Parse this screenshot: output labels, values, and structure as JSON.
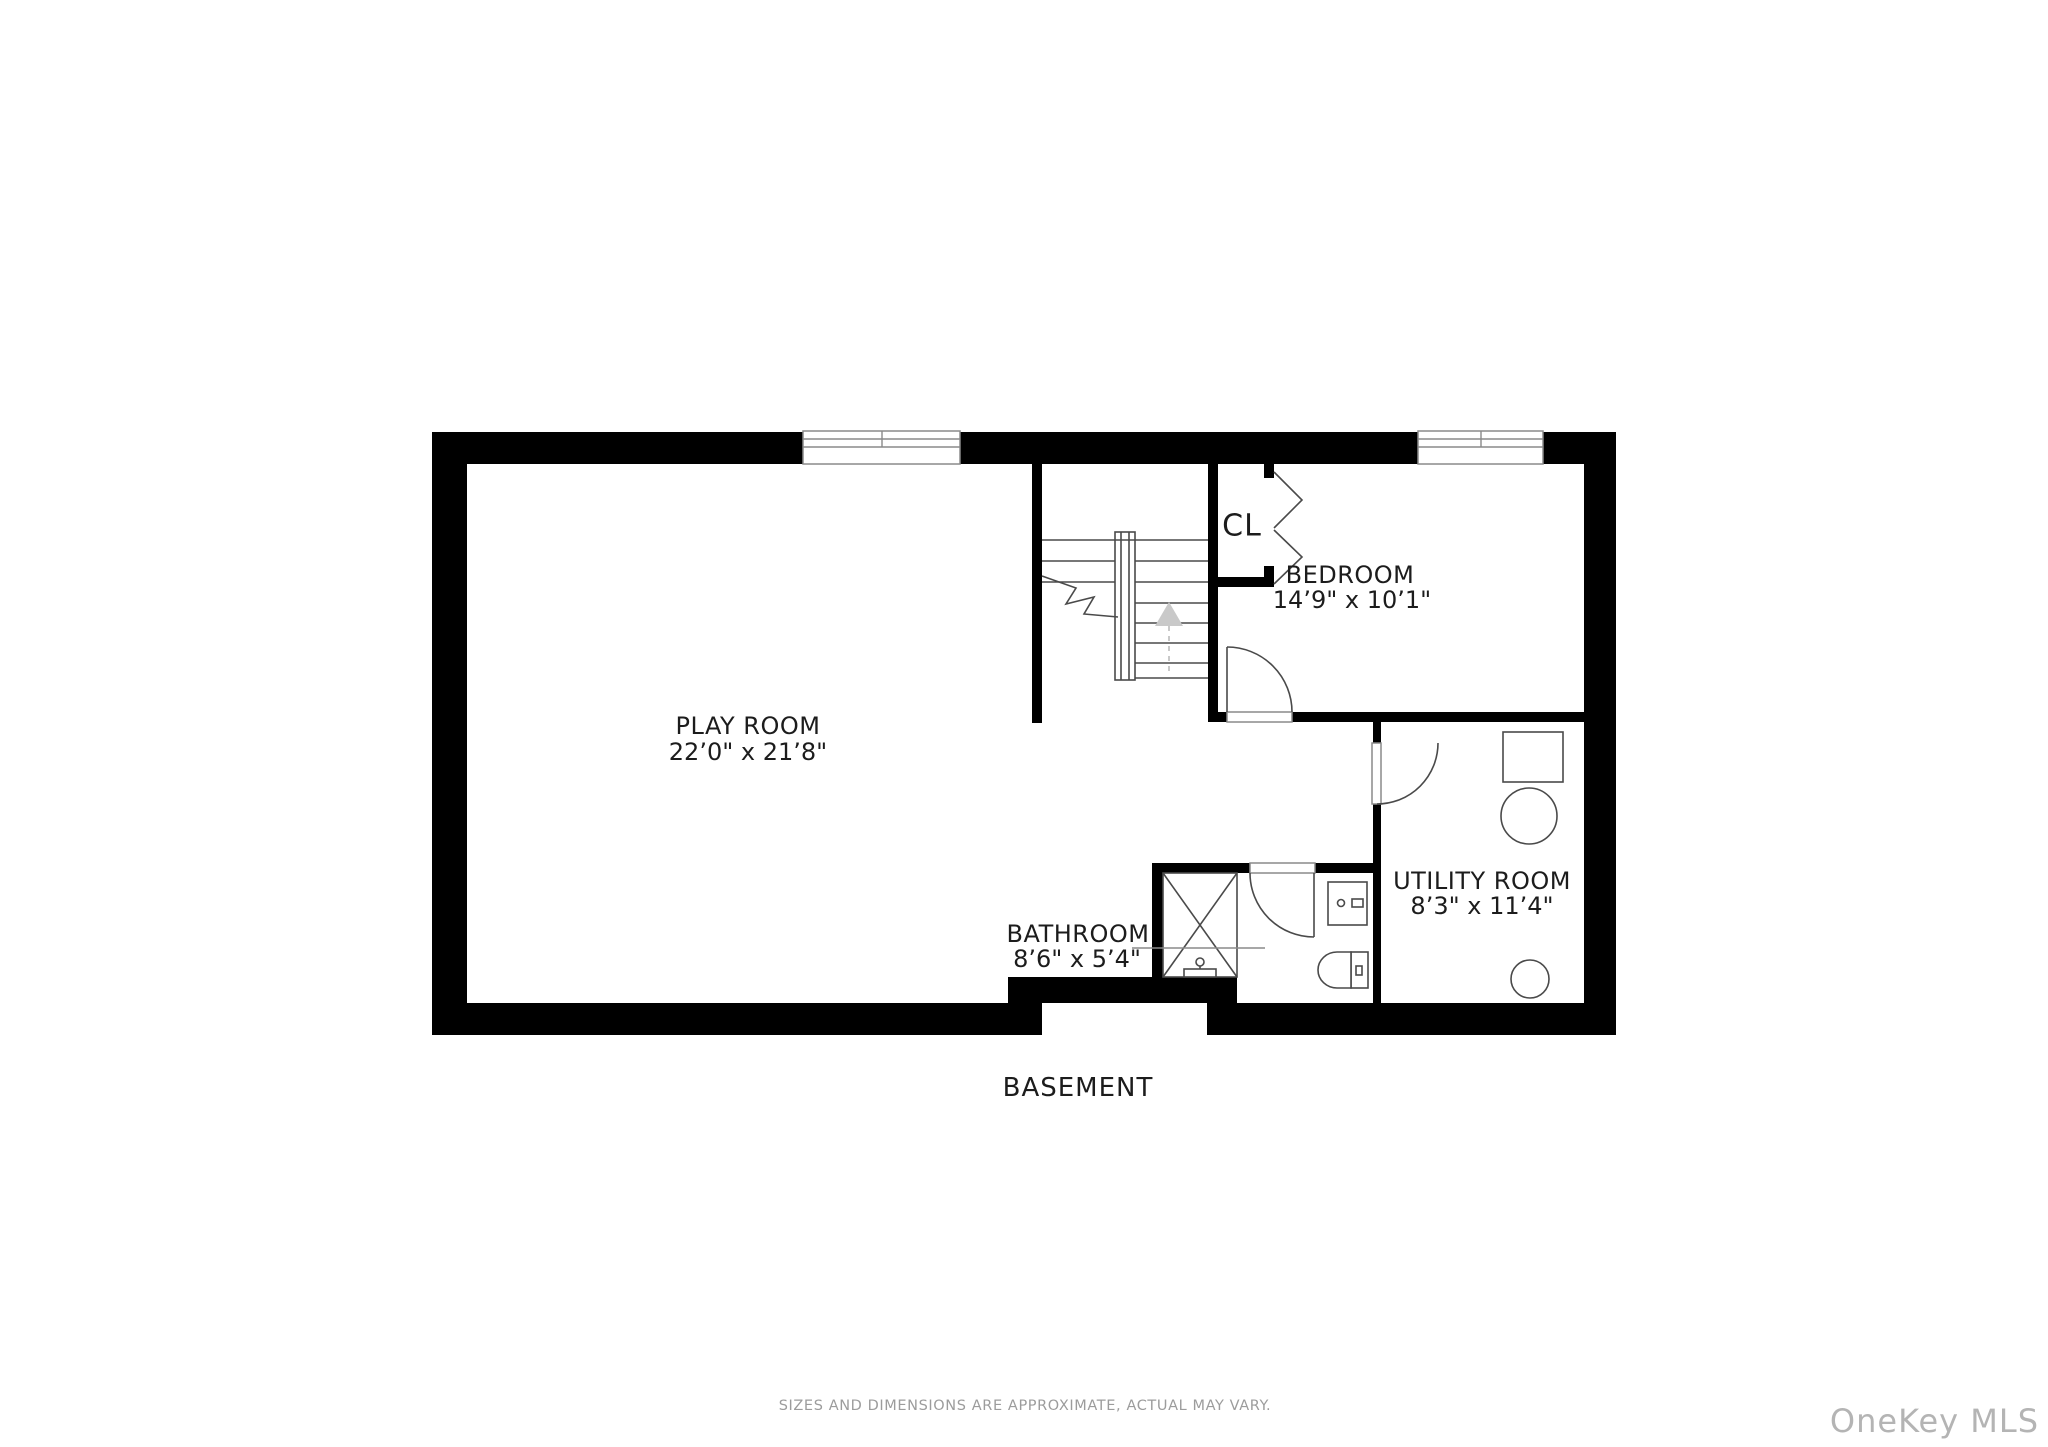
{
  "colors": {
    "wall": "#000000",
    "line": "#4a4a4a",
    "frame": "#8a8a8a",
    "arrow": "#c9c9c9",
    "label": "#1c1c1c",
    "muted": "#9c9c9c",
    "watermark": "#b4b4b4"
  },
  "plan": {
    "floor_label": "BASEMENT",
    "rooms": [
      {
        "id": "play-room",
        "name": "PLAY ROOM",
        "dimensions": "22’0\" x 21’8\""
      },
      {
        "id": "bedroom",
        "name": "BEDROOM",
        "dimensions": "14’9\" x 10’1\""
      },
      {
        "id": "bathroom",
        "name": "BATHROOM",
        "dimensions": "8’6\" x 5’4\""
      },
      {
        "id": "utility-room",
        "name": "UTILITY ROOM",
        "dimensions": "8’3\" x 11’4\""
      },
      {
        "id": "closet",
        "name": "CL"
      }
    ],
    "features": [
      "stairs-up",
      "closet-bifold-doors",
      "two-windows-top-wall",
      "shower",
      "vanity-sink",
      "toilet",
      "washer",
      "utility-tank",
      "utility-drain"
    ]
  },
  "footer": {
    "disclaimer": "SIZES AND DIMENSIONS ARE APPROXIMATE, ACTUAL MAY VARY."
  },
  "watermark": {
    "text": "OneKey MLS"
  }
}
